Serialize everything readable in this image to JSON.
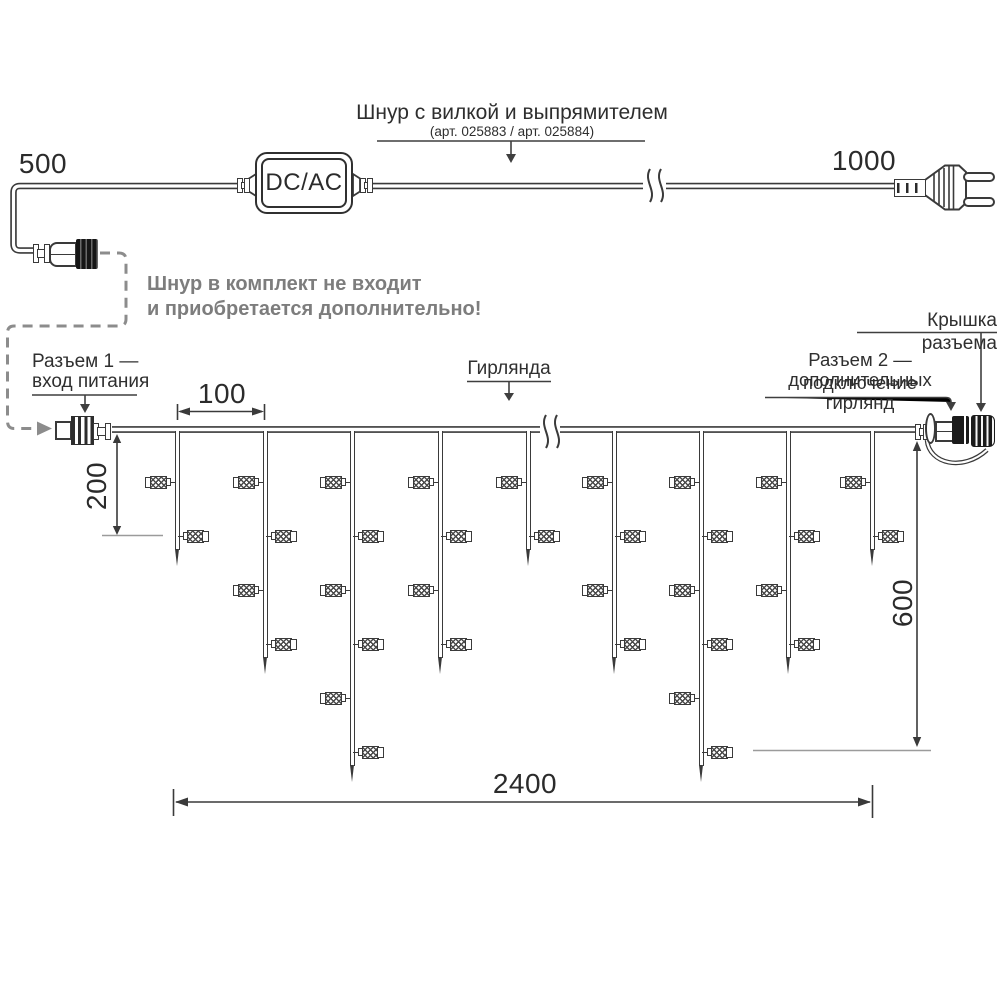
{
  "diagram": {
    "power_cord": {
      "label": "Шнур с вилкой и выпрямителем",
      "sublabel": "(арт. 025883 / арт. 025884)",
      "converter": "DC/AC",
      "left_length": "500",
      "right_length": "1000"
    },
    "note": {
      "line1": "Шнур в комплект не входит",
      "line2": "и приобретается дополнительно!"
    },
    "connector1": {
      "line1": "Разъем 1 —",
      "line2": "вход питания"
    },
    "garland_label": "Гирлянда",
    "connector2": {
      "line1": "Разъем 2 — подключение",
      "line2": "дополнительных гирлянд"
    },
    "cap_label": "Крышка разъема",
    "dimensions": {
      "drop_spacing": "100",
      "short_drop": "200",
      "long_drop": "600",
      "total_length": "2400"
    },
    "garland": {
      "drop_top": 431,
      "rows_y": [
        482,
        536,
        590,
        644,
        698,
        752
      ],
      "tip_extra": 30,
      "drops": [
        {
          "x": 177,
          "lamps": 2
        },
        {
          "x": 265,
          "lamps": 4
        },
        {
          "x": 352,
          "lamps": 6
        },
        {
          "x": 440,
          "lamps": 4
        },
        {
          "x": 528,
          "lamps": 2
        },
        {
          "x": 614,
          "lamps": 4
        },
        {
          "x": 701,
          "lamps": 6
        },
        {
          "x": 788,
          "lamps": 4
        },
        {
          "x": 872,
          "lamps": 2
        }
      ]
    },
    "colors": {
      "line": "#3a3a3a",
      "text": "#2e2e2e",
      "note_gray": "#7d7d7d",
      "dashed_gray": "#8c8c8c",
      "tick_gray": "#9b9b9b"
    }
  }
}
